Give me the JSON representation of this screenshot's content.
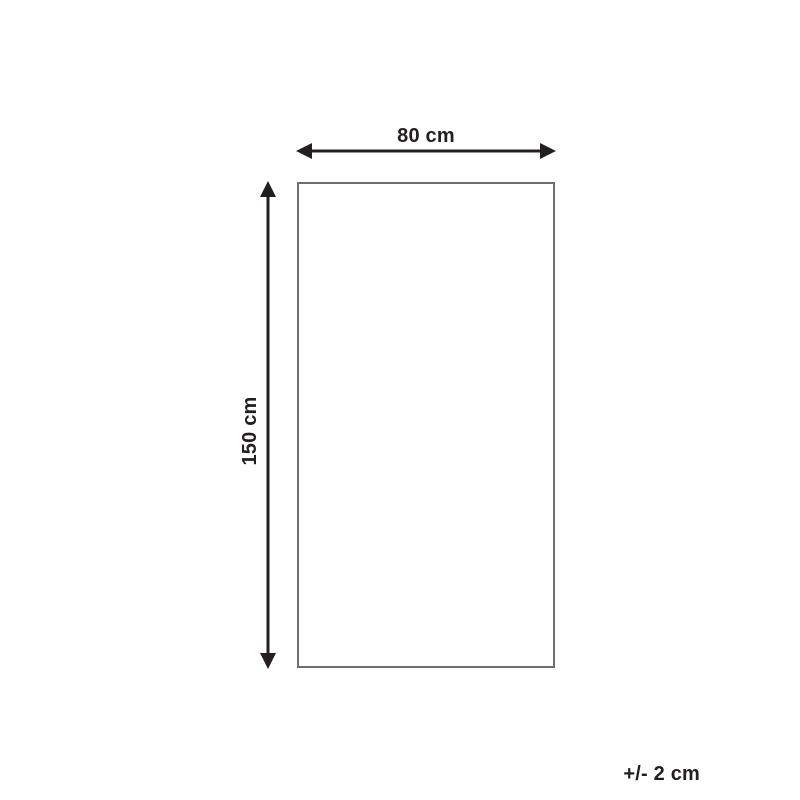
{
  "diagram": {
    "width_label": "80 cm",
    "height_label": "150 cm",
    "tolerance_label": "+/- 2 cm",
    "colors": {
      "arrow": "#231f20",
      "outline": "#6d6e71",
      "text": "#231f20",
      "background": "#ffffff"
    }
  }
}
